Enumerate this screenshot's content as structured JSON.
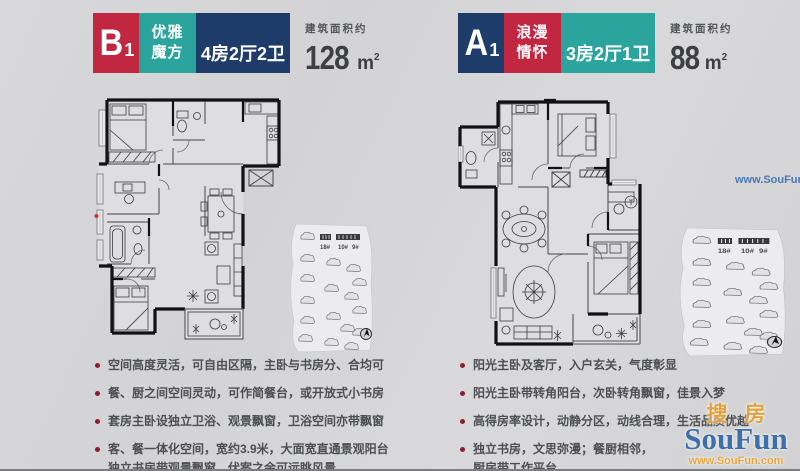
{
  "page": {
    "background": "#d4d4d6",
    "bottom_line_color": "#7d7d81"
  },
  "watermarks": {
    "top_right_url": "www.SouFun.com",
    "logo": {
      "cn_left": "搜",
      "cn_right": "房",
      "en": "SouFun",
      "url": "www.SouFun.com",
      "cn_color": "#e2a23b",
      "en_color": "#3f6fa9",
      "url_color": "#e8a43c"
    }
  },
  "units": [
    {
      "code": "B",
      "code_sub": "1",
      "name_line1": "优雅",
      "name_line2": "魔方",
      "rooms": "4房2厅2卫",
      "area_label": "建筑面积约",
      "area_value": "128",
      "area_unit": "m",
      "area_sup": "2",
      "colors": {
        "code_bg": "#c22742",
        "name_bg": "#2aa49c",
        "rooms_bg": "#1d3c6a"
      },
      "site_labels": {
        "l1": "18#",
        "l2": "10#",
        "l3": "9#"
      },
      "bullets": [
        [
          "空间高度灵活，可自由区隔，主卧与书房分、合均可"
        ],
        [
          "餐、厨之间空间灵动，可作简餐台，或开放式小书房"
        ],
        [
          "套房主卧设独立卫浴、观景飘窗，卫浴空间亦带飘窗"
        ],
        [
          "客、餐一体化空间，宽约3.9米，大面宽直通景观阳台",
          "独立书房带观景飘窗，伏案之余可远眺风景"
        ]
      ]
    },
    {
      "code": "A",
      "code_sub": "1",
      "name_line1": "浪漫",
      "name_line2": "情怀",
      "rooms": "3房2厅1卫",
      "area_label": "建筑面积约",
      "area_value": "88",
      "area_unit": "m",
      "area_sup": "2",
      "colors": {
        "code_bg": "#1d3c6a",
        "name_bg": "#c22742",
        "rooms_bg": "#2aa49c"
      },
      "site_labels": {
        "l1": "18#",
        "l2": "10#",
        "l3": "9#"
      },
      "bullets": [
        [
          "阳光主卧及客厅，入户玄关，气度彰显"
        ],
        [
          "阳光主卧带转角阳台，次卧转角飘窗，佳景入梦"
        ],
        [
          "高得房率设计，动静分区，动线合理，生活品质优越"
        ],
        [
          "独立书房，文思弥漫；餐厨相邻，",
          "厨房带工作平台"
        ]
      ]
    }
  ]
}
